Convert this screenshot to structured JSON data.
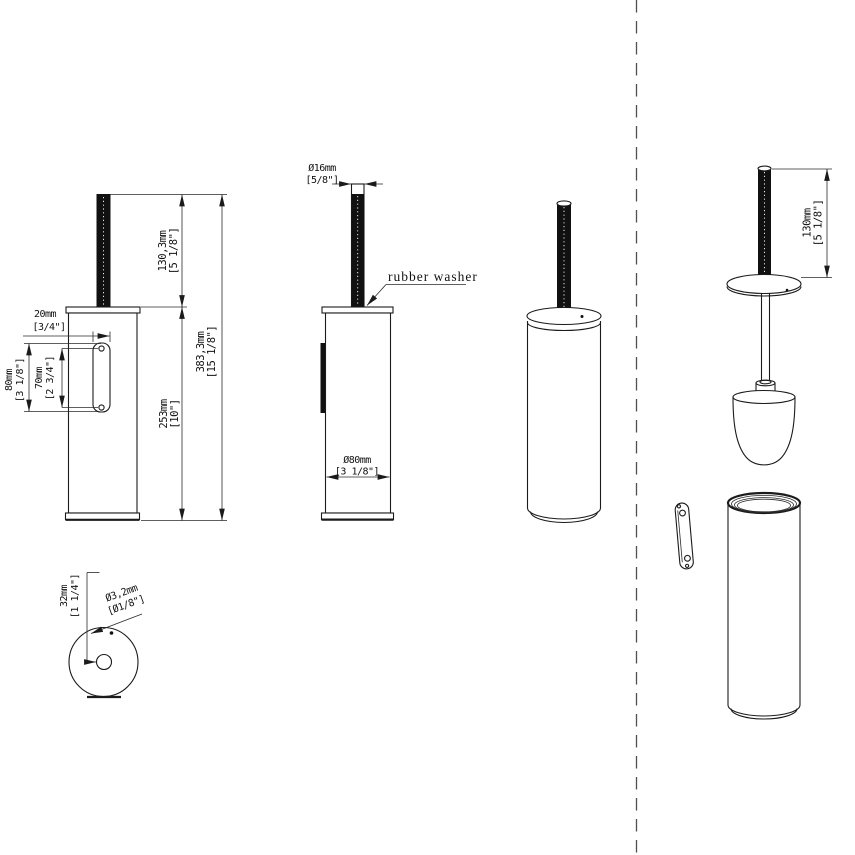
{
  "drawing_type": "toilet-brush-holder-technical-drawing",
  "colors": {
    "background": "#ffffff",
    "line": "#1b1b1b",
    "handle_fill": "#111111",
    "separator": "#4f4f4f"
  },
  "d": {
    "side": {
      "plate_depth": [
        "20mm",
        "[3/4\"]"
      ],
      "plate_height": [
        "80mm",
        "[3 1/8\"]"
      ],
      "hole_spacing": [
        "70mm",
        "[2 3/4\"]"
      ],
      "handle_length": [
        "130,3mm",
        "[5 1/8\"]"
      ],
      "body_height": [
        "253mm",
        "[10\"]"
      ],
      "total_height": [
        "383,3mm",
        "[15 1/8\"]"
      ]
    },
    "front": {
      "handle_dia": [
        "Ø16mm",
        "[5/8\"]"
      ],
      "body_dia": [
        "Ø80mm",
        "[3 1/8\"]"
      ],
      "note": "rubber washer"
    },
    "bottom": {
      "offset": [
        "32mm",
        "[1 1/4\"]"
      ],
      "hole_dia": [
        "Ø3,2mm",
        "[Ø1/8\"]"
      ]
    },
    "exploded": {
      "handle_length": [
        "130mm",
        "[5 1/8\"]"
      ]
    }
  }
}
